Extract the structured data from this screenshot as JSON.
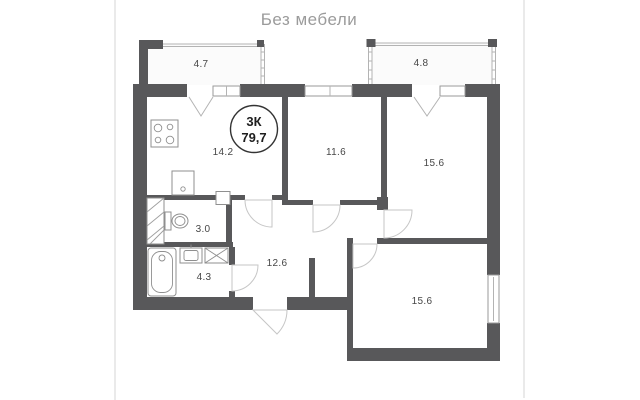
{
  "view_label": "Без мебели",
  "floor_plan": {
    "badge": {
      "rooms": "3К",
      "total_area": "79,7"
    },
    "rooms": [
      {
        "name": "balcony-left",
        "area": "4.7"
      },
      {
        "name": "balcony-right",
        "area": "4.8"
      },
      {
        "name": "kitchen",
        "area": "14.2"
      },
      {
        "name": "room-top-middle",
        "area": "11.6"
      },
      {
        "name": "room-top-right",
        "area": "15.6"
      },
      {
        "name": "toilet",
        "area": "3.0"
      },
      {
        "name": "hallway",
        "area": "12.6"
      },
      {
        "name": "bathroom",
        "area": "4.3"
      },
      {
        "name": "room-bottom-right",
        "area": "15.6"
      }
    ],
    "fixtures": [
      "stove-icon",
      "kitchen-sink-icon",
      "toilet-icon",
      "bathtub-icon",
      "washbasin-icon",
      "washing-machine-icon"
    ],
    "colors": {
      "wall": "#58585a",
      "thin_line": "#b3b3b3",
      "label_text": "#464646",
      "title_text": "#9b9b9b",
      "divider": "#e2e2e2",
      "balcony_fill": "#fbfbfb"
    }
  }
}
